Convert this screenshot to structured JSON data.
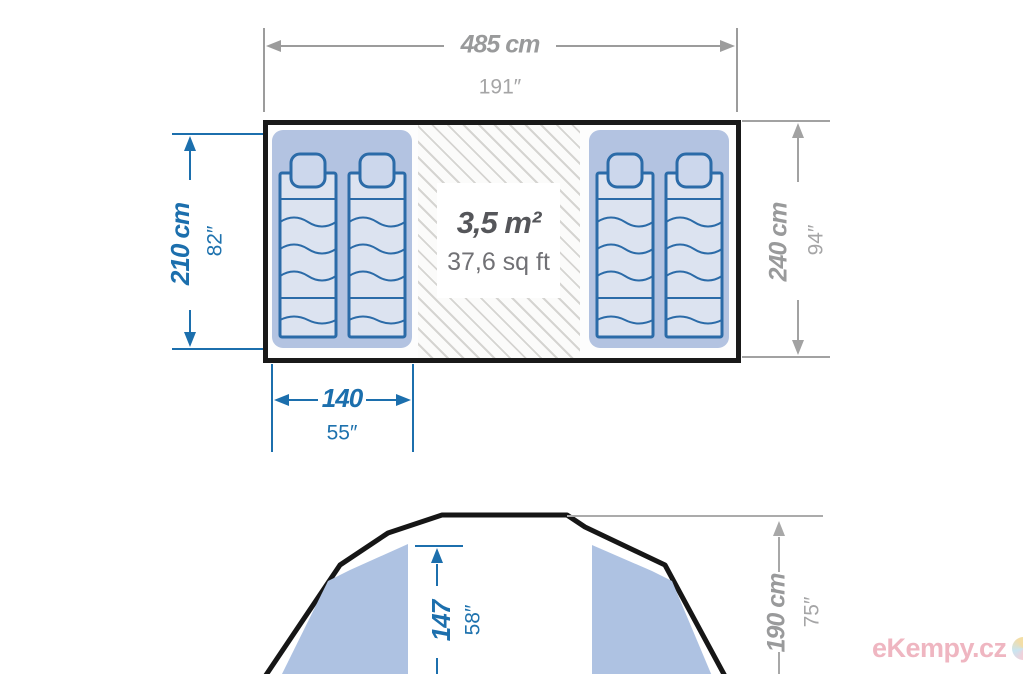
{
  "diagram": {
    "floor_plan": {
      "overall_width": {
        "metric": "485 cm",
        "imperial": "191″"
      },
      "overall_depth": {
        "metric": "240 cm",
        "imperial": "94″"
      },
      "bedroom_depth": {
        "metric": "210 cm",
        "imperial": "82″"
      },
      "bedroom_width": {
        "metric": "140",
        "imperial": "55″"
      },
      "living_area": {
        "metric": "3,5 m²",
        "imperial": "37,6 sq ft"
      }
    },
    "front_view": {
      "inner_height": {
        "metric": "147",
        "imperial": "58″"
      },
      "peak_height": {
        "metric": "190 cm",
        "imperial": "75″"
      }
    },
    "colors": {
      "dimension_blue": "#1c6fad",
      "dimension_gray": "#999a9b",
      "outline_black": "#191919",
      "pod_fill": "#b3c3e1",
      "mattress_fill": "#dce3f0",
      "mattress_stroke": "#2b6ba8",
      "tent_panel_fill": "#aec2e2",
      "watermark_pink": "#efb6c1"
    },
    "watermark": "eKempy.cz"
  }
}
